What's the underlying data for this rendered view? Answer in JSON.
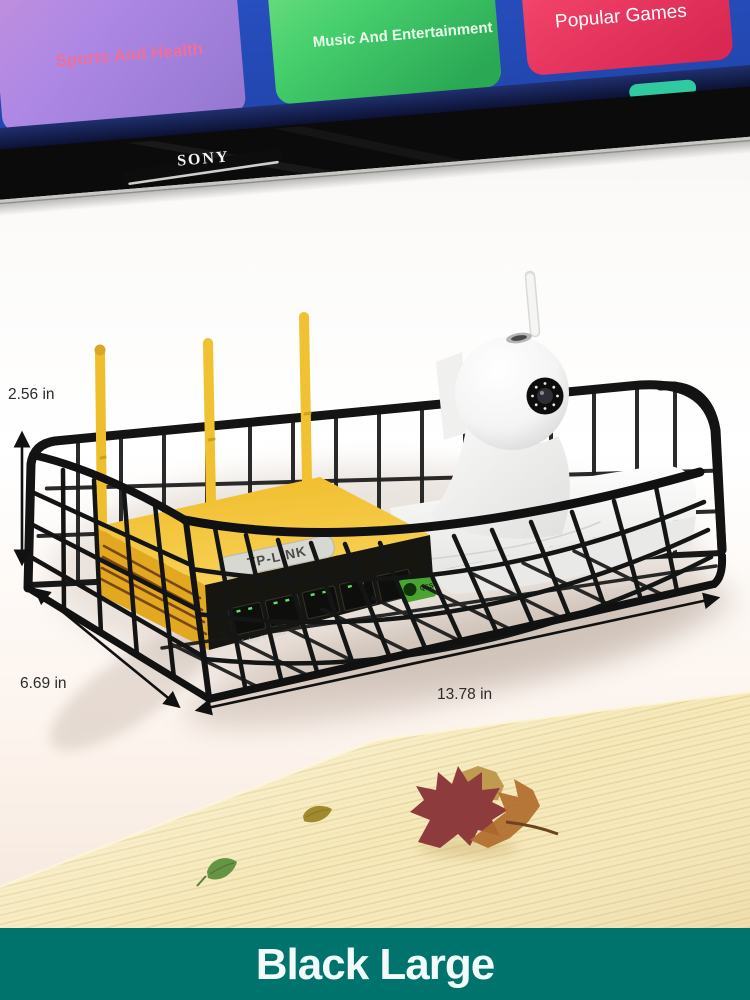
{
  "tv": {
    "brand_logo": "SONY",
    "screen_color": "#2b53c6",
    "app_tiles": [
      {
        "label": "Sports And Health",
        "color": "#a989e2",
        "label_color": "#ee6f9e"
      },
      {
        "label": "Music And Entertainment",
        "color": "#46cf6d",
        "label_color": "#e9fdec"
      },
      {
        "label": "Popular Games",
        "color": "#ef4067",
        "label_color": "#ffffff"
      }
    ]
  },
  "product": {
    "shelf_color": "#161616",
    "router": {
      "brand_label": "TP-LINK",
      "front_text": "Wireless N Gigabit Router",
      "button_label": "QSS",
      "body_color": "#f2c233"
    },
    "camera_color": "#f7f7f7"
  },
  "dimensions": {
    "height_label": "2.56 in",
    "depth_label": "6.69 in",
    "width_label": "13.78 in"
  },
  "variant_banner": {
    "label": "Black Large",
    "background_color": "#00736d",
    "text_color": "#f2fbfa"
  }
}
